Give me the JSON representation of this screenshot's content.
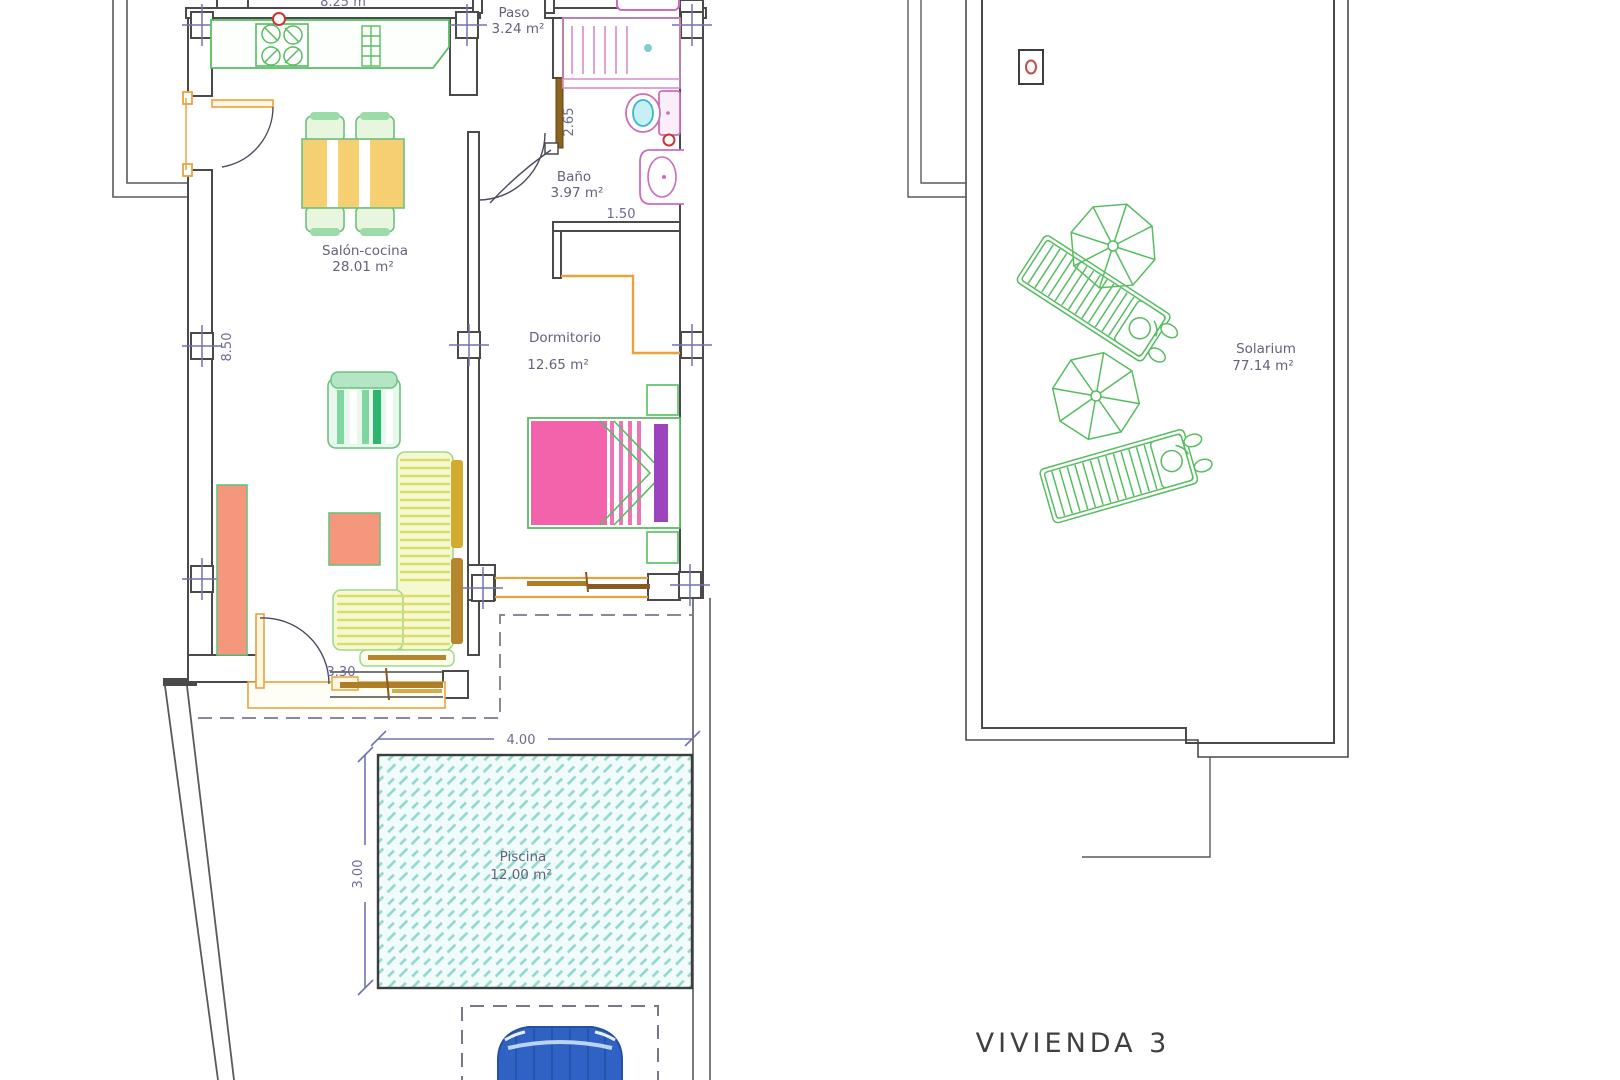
{
  "drawing": {
    "plan_title": "VIVIENDA 3",
    "rooms": {
      "paso": {
        "name": "Paso",
        "area": "3.24 m²"
      },
      "bano": {
        "name": "Baño",
        "area": "3.97 m²"
      },
      "salon": {
        "name": "Salón-cocina",
        "area": "28.01 m²"
      },
      "dormitorio": {
        "name": "Dormitorio",
        "area": "12.65 m²"
      },
      "piscina": {
        "name": "Piscina",
        "area": "12.00 m²"
      },
      "solarium": {
        "name": "Solarium",
        "area": "77.14 m²"
      }
    },
    "dimensions": {
      "top_width": "8.25 m",
      "salon_height": "8.50",
      "bath_depth": "2.65",
      "bath_width": "1.50",
      "porch_door": "3.30",
      "pool_width": "4.00",
      "pool_height": "3.00"
    },
    "colors": {
      "wall": "#4a4a4a",
      "boundary": "#5a5a5a",
      "dashed": "#8a8a9a",
      "pillar_cross": "#7272b2",
      "green": "#57bd61",
      "light_green": "#9fd98f",
      "orange": "#e8a33d",
      "brown": "#ad7d28",
      "pink": "#cd6bbd",
      "bed_pink": "#f263ab",
      "purple": "#9b44bd",
      "cyan_fixture": "#35b8cc",
      "pool_hatch": "#8fd8d0",
      "salmon": "#f4977c",
      "table_yellow": "#f6cf72",
      "sofa_pale": "#f6f8cf",
      "sofa_stripe": "#d9dd70",
      "mustard": "#d2ac2e",
      "car_blue": "#2f62c4",
      "red": "#cc3333"
    }
  }
}
